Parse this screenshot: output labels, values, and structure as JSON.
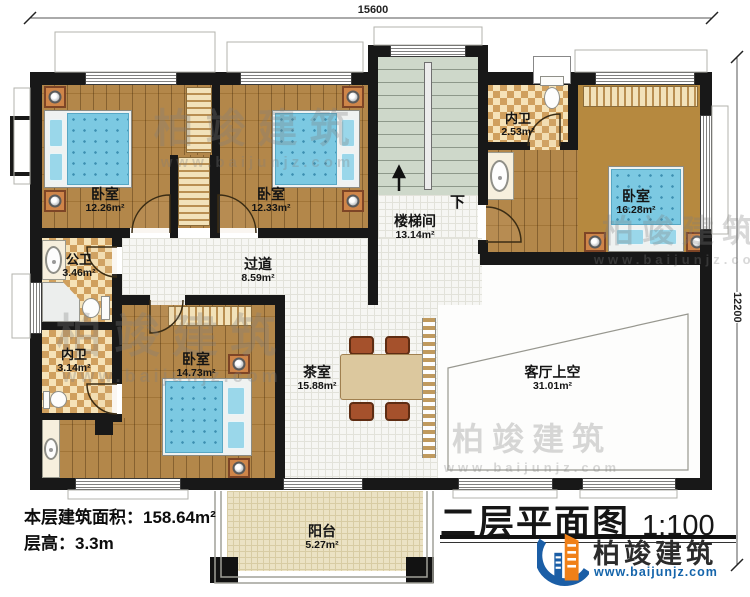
{
  "dimensions": {
    "width_mm": "15600",
    "height_mm": "12200"
  },
  "rooms": {
    "bedroom_top_left": {
      "name": "卧室",
      "area": "12.26m²"
    },
    "bedroom_top_mid": {
      "name": "卧室",
      "area": "12.33m²"
    },
    "stair_hall": {
      "name": "楼梯间",
      "area": "13.14m²"
    },
    "bath_top": {
      "name": "内卫",
      "area": "2.53m²"
    },
    "bedroom_right": {
      "name": "卧室",
      "area": "16.28m²"
    },
    "bath_public": {
      "name": "公卫",
      "area": "3.46m²"
    },
    "hallway": {
      "name": "过道",
      "area": "8.59m²"
    },
    "bath_lower": {
      "name": "内卫",
      "area": "3.14m²"
    },
    "bedroom_bottom": {
      "name": "卧室",
      "area": "14.73m²"
    },
    "tea_room": {
      "name": "茶室",
      "area": "15.88m²"
    },
    "living_room_void": {
      "name": "客厅上空",
      "area": "31.01m²"
    },
    "balcony": {
      "name": "阳台",
      "area": "5.27m²"
    }
  },
  "stairs": {
    "direction_label": "下"
  },
  "notes": {
    "floor_area": "本层建筑面积：158.64m²",
    "floor_height": "层高：3.3m"
  },
  "title_block": {
    "title": "二层平面图",
    "scale": "1:100"
  },
  "brand": {
    "name": "柏竣建筑",
    "website": "www.baijunjz.com"
  },
  "watermark": {
    "text": "柏竣建筑",
    "url": "www.baijunjz.com"
  },
  "colors": {
    "wall": "#181818",
    "wood_floor": "#ad7e3c",
    "bed": "#7cc9e2",
    "stair": "#ced8ca",
    "brand_blue": "#1b5ea6",
    "brand_orange": "#f08018"
  }
}
